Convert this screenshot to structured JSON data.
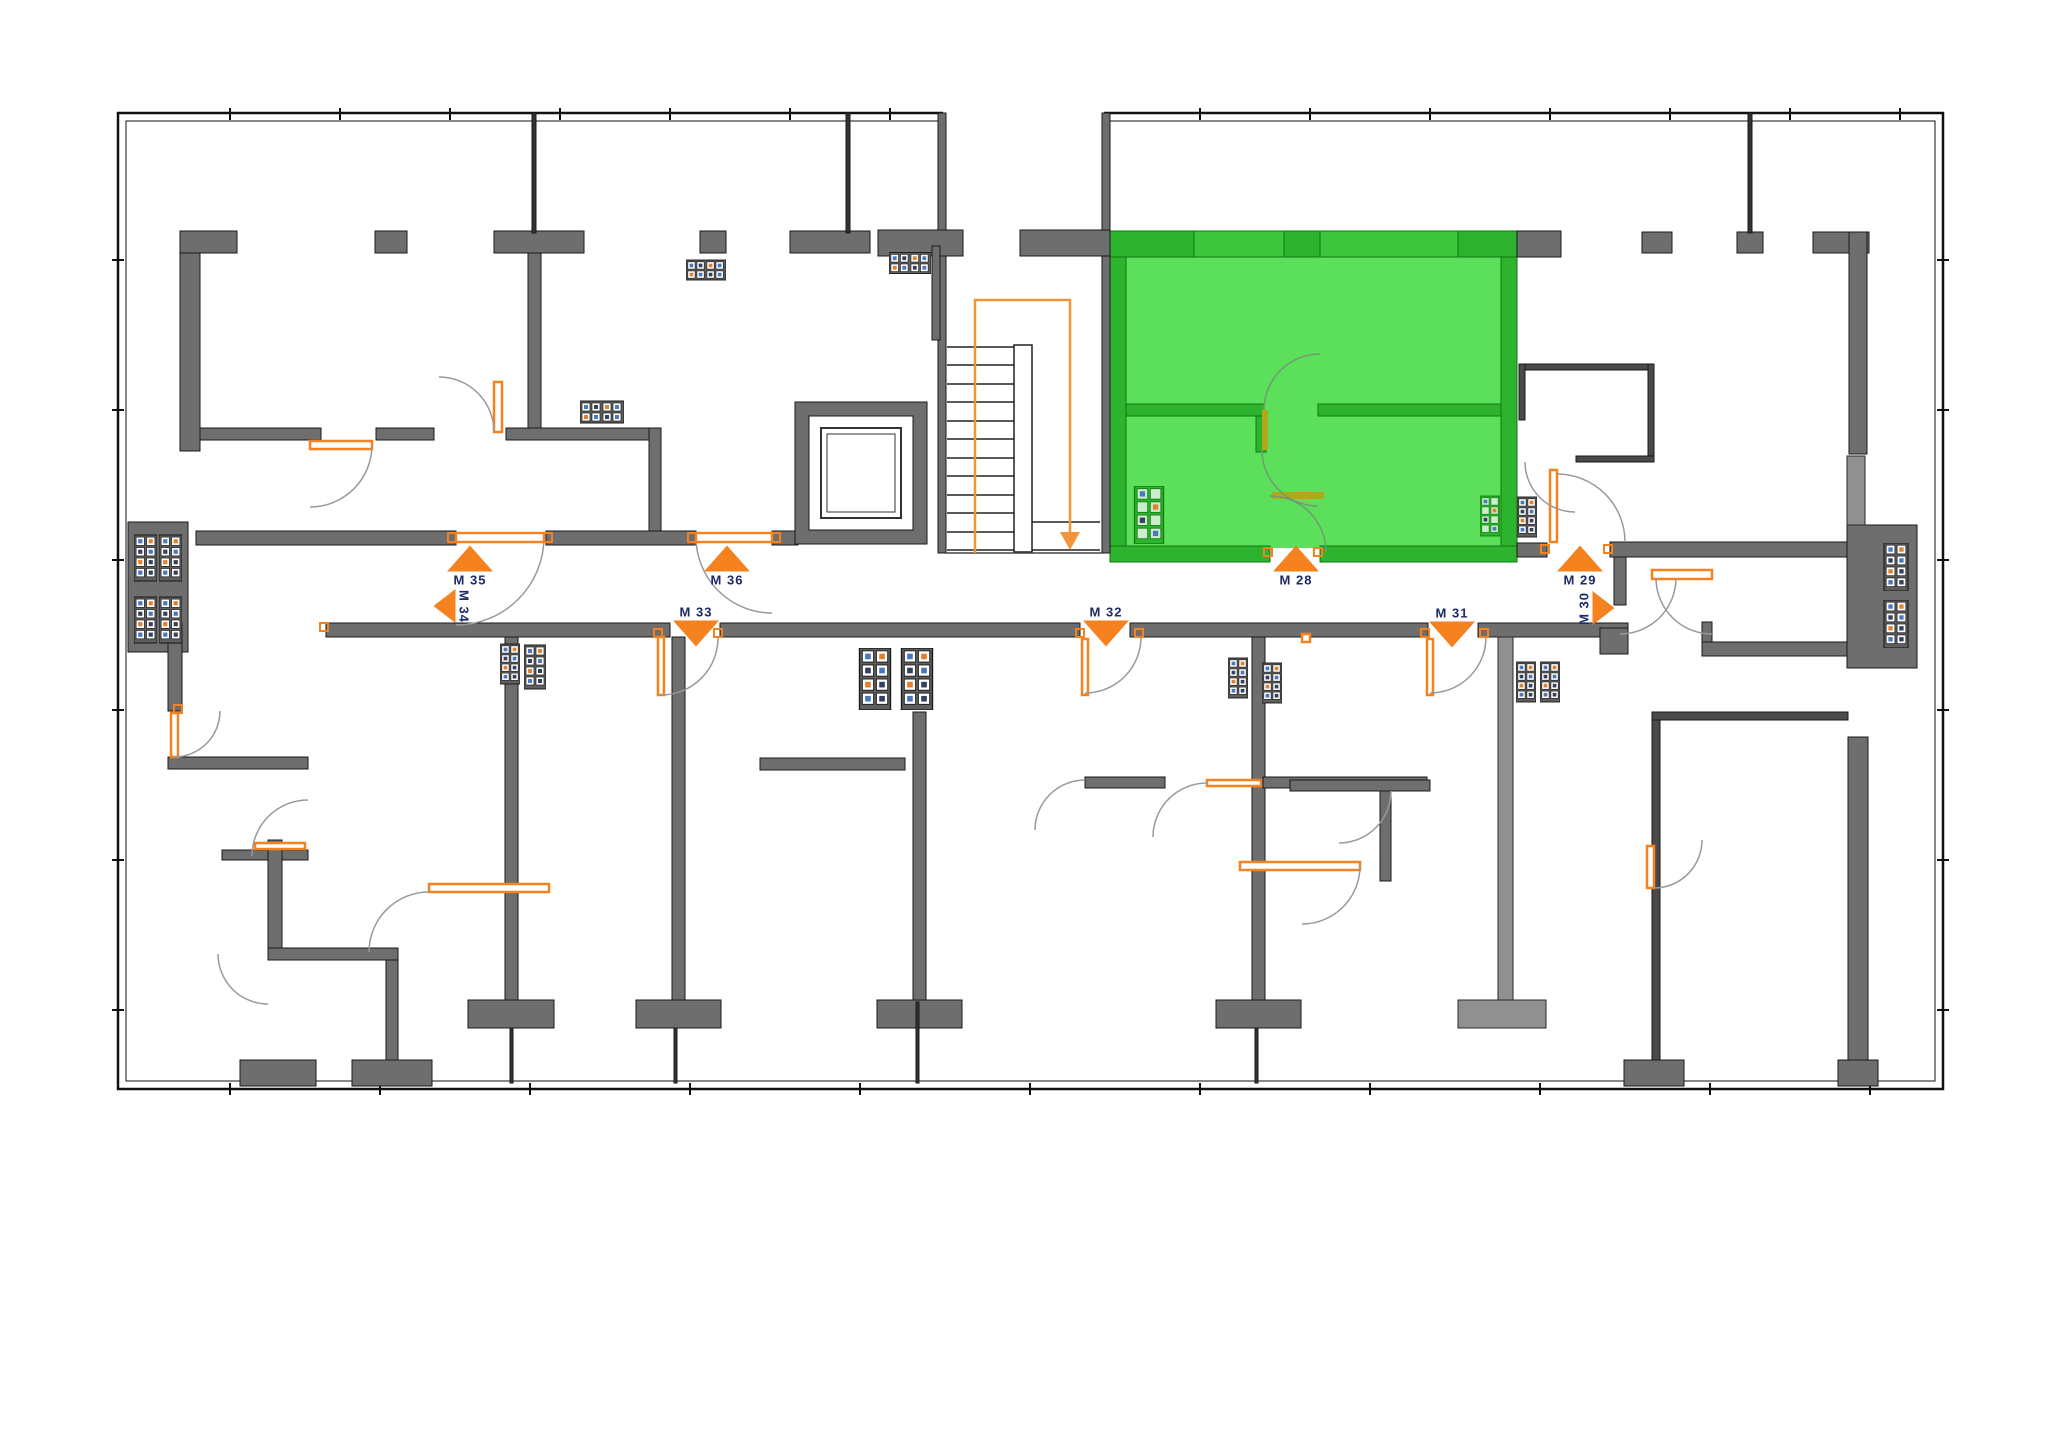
{
  "floorplan": {
    "type": "residential-building-floor-plan",
    "selected_apartment": "M 28",
    "colors": {
      "background": "#ffffff",
      "wall_gray": "#6e6e6e",
      "wall_light_gray": "#909090",
      "highlight_wall_green": "#2db32d",
      "highlight_fill_green": "#5ce05c",
      "accent_orange": "#f5821f",
      "door_leaf_olive": "#b0a818",
      "label_text": "#1c2a66"
    },
    "markers": [
      {
        "id": "m35",
        "label": "M 35",
        "direction": "up",
        "highlighted": false
      },
      {
        "id": "m34",
        "label": "M 34",
        "direction": "left",
        "highlighted": false
      },
      {
        "id": "m36",
        "label": "M 36",
        "direction": "up",
        "highlighted": false
      },
      {
        "id": "m33",
        "label": "M 33",
        "direction": "down",
        "highlighted": false
      },
      {
        "id": "m28",
        "label": "M 28",
        "direction": "up",
        "highlighted": true
      },
      {
        "id": "m32",
        "label": "M 32",
        "direction": "down",
        "highlighted": false
      },
      {
        "id": "m31",
        "label": "M 31",
        "direction": "down",
        "highlighted": false
      },
      {
        "id": "m29",
        "label": "M 29",
        "direction": "up",
        "highlighted": false
      },
      {
        "id": "m30",
        "label": "M 30",
        "direction": "right",
        "highlighted": false
      }
    ]
  }
}
